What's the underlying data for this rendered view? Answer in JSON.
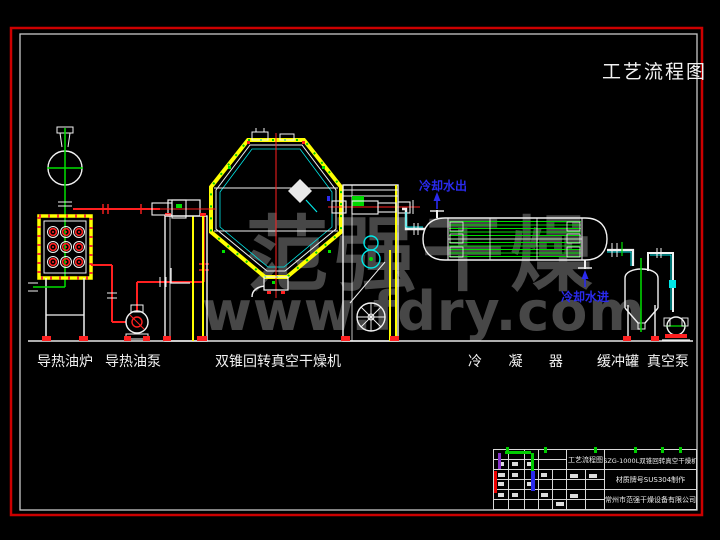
{
  "title": "工艺流程图",
  "equipment_labels": [
    {
      "id": "oil-furnace",
      "label": "导热油炉"
    },
    {
      "id": "oil-pump",
      "label": "导热油泵"
    },
    {
      "id": "double-cone-dryer",
      "label": "双锥回转真空干燥机"
    },
    {
      "id": "condenser",
      "label": "冷 凝 器"
    },
    {
      "id": "buffer-tank",
      "label": "缓冲罐"
    },
    {
      "id": "vacuum-pump",
      "label": "真空泵"
    }
  ],
  "annotations": {
    "cooling_water_out": "冷却水出",
    "cooling_water_in": "冷却水进"
  },
  "watermark": {
    "line1": "范强干燥",
    "line2": "www.fdry.com"
  },
  "title_block": {
    "drawing_name": "工艺流程图",
    "model": "SZG-1000L双锥回转真空干燥机",
    "material": "材质牌号SUS304制作",
    "company": "常州市范强干燥设备有限公司"
  },
  "colors": {
    "background": "#000000",
    "frame_red": "#cc0000",
    "frame_white": "#cccccc",
    "line_white": "#f2f2f2",
    "cad_yellow": "#ffff00",
    "cad_red": "#ff2020",
    "cad_green": "#00e000",
    "cad_cyan": "#00e8e8",
    "annotation_blue": "#2a2aee",
    "watermark_gray": "#474747"
  }
}
